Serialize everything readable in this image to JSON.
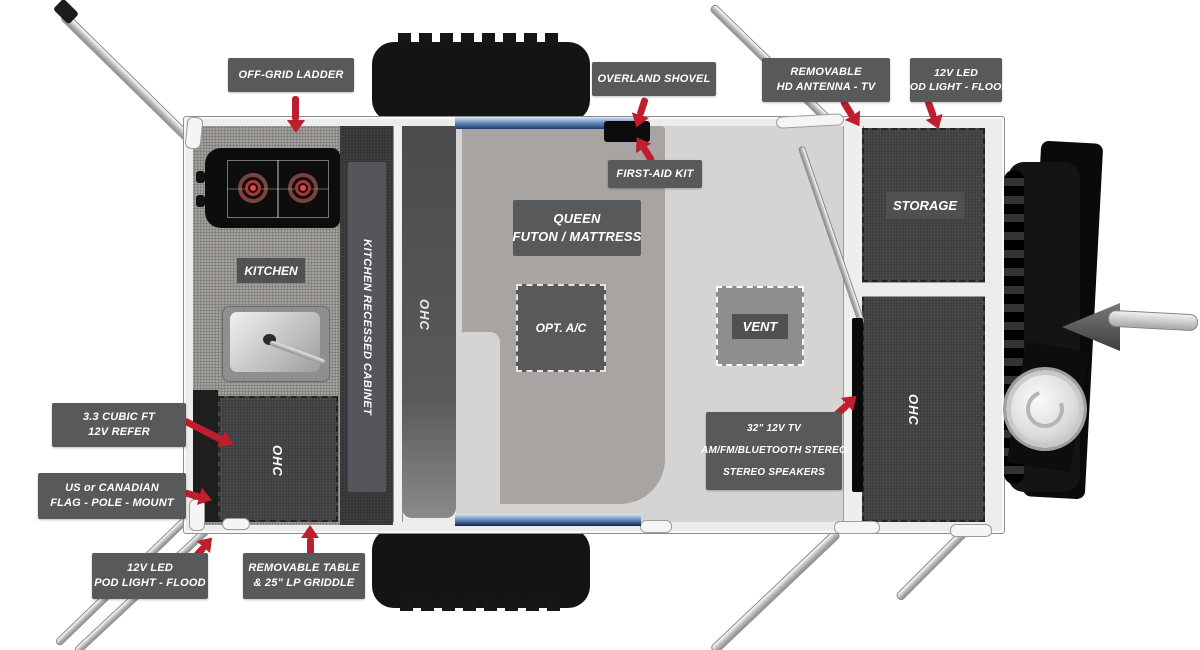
{
  "meta": {
    "title": "Teardrop travel trailer floor plan diagram"
  },
  "colors": {
    "label_bg": "#58595b",
    "label_text": "#ffffff",
    "arrow_red": "#be1e2d",
    "floor_light": "#d6d4d2",
    "floor_futon": "#a8a4a1",
    "cabinet_dark": "#3f3f41",
    "wall_silver": "#ececec",
    "tire_black": "#141414",
    "accent_blue": "#5b84bb"
  },
  "callouts": {
    "off_grid_ladder": {
      "lines": [
        "OFF-GRID LADDER"
      ]
    },
    "overland_shovel": {
      "lines": [
        "OVERLAND SHOVEL"
      ]
    },
    "removable_antenna": {
      "lines": [
        "REMOVABLE",
        "HD ANTENNA - TV"
      ]
    },
    "pod_light_top": {
      "lines": [
        "12V LED",
        "POD LIGHT - FLOOD"
      ]
    },
    "first_aid_kit": {
      "lines": [
        "FIRST-AID KIT"
      ]
    },
    "refer": {
      "lines": [
        "3.3  CUBIC FT",
        "12V REFER"
      ]
    },
    "flag_pole": {
      "lines": [
        "US or CANADIAN",
        "FLAG - POLE - MOUNT"
      ]
    },
    "pod_light_bottom": {
      "lines": [
        "12V LED",
        "POD LIGHT - FLOOD"
      ]
    },
    "removable_table": {
      "lines": [
        "REMOVABLE TABLE",
        "& 25\" LP GRIDDLE"
      ]
    },
    "tv_stereo": {
      "lines": [
        "32\" 12V TV",
        "AM/FM/BLUETOOTH STEREO",
        "STEREO SPEAKERS"
      ]
    }
  },
  "plan": {
    "kitchen_label": "KITCHEN",
    "kitchen_recessed_cabinet_label": "KITCHEN RECESSED CABINET",
    "ohc_galley_label": "OHC",
    "ohc_mid_label": "OHC",
    "ohc_rear_label": "OHC",
    "queen_line1": "QUEEN",
    "queen_line2": "FUTON / MATTRESS",
    "opt_ac_label": "OPT. A/C",
    "vent_label": "VENT",
    "storage_label": "STORAGE"
  }
}
